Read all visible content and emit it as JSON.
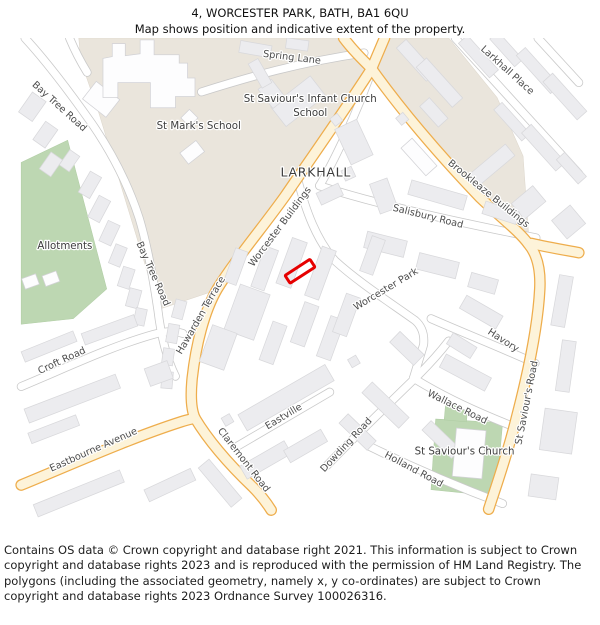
{
  "header": {
    "title": "4, WORCESTER PARK, BATH, BA1 6QU",
    "subtitle": "Map shows position and indicative extent of the property."
  },
  "map": {
    "plot_color": "#e60000",
    "area_colors": {
      "school_grounds": "#eae5dc",
      "greenspace": "#bdd7b2",
      "a_road_fill": "#fdf3d9",
      "a_road_casing": "#eead4c"
    },
    "labels": [
      {
        "id": "spring-lane",
        "text": "Spring Lane"
      },
      {
        "id": "larkhall-place",
        "text": "Larkhall Place"
      },
      {
        "id": "bay-tree-road-north",
        "text": "Bay Tree Road"
      },
      {
        "id": "st-marks-school",
        "text": "St Mark's School"
      },
      {
        "id": "st-saviours-infant-line1",
        "text": "St Saviour's Infant Church"
      },
      {
        "id": "st-saviours-infant-line2",
        "text": "School"
      },
      {
        "id": "larkhall",
        "text": "LARKHALL"
      },
      {
        "id": "brookleaze-buildings",
        "text": "Brookleaze Buildings"
      },
      {
        "id": "salisbury-road",
        "text": "Salisbury Road"
      },
      {
        "id": "worcester-buildings",
        "text": "Worcester Buildings"
      },
      {
        "id": "allotments",
        "text": "Allotments"
      },
      {
        "id": "bay-tree-road-mid",
        "text": "Bay Tree Road"
      },
      {
        "id": "worcester-park",
        "text": "Worcester Park"
      },
      {
        "id": "hawarden-terrace",
        "text": "Hawarden Terrace"
      },
      {
        "id": "havory",
        "text": "Havory"
      },
      {
        "id": "croft-road",
        "text": "Croft Road"
      },
      {
        "id": "st-saviours-road",
        "text": "St Saviour's Road"
      },
      {
        "id": "wallace-road",
        "text": "Wallace Road"
      },
      {
        "id": "eastville",
        "text": "Eastville"
      },
      {
        "id": "dowding-road",
        "text": "Dowding Road"
      },
      {
        "id": "eastbourne-avenue",
        "text": "Eastbourne Avenue"
      },
      {
        "id": "st-saviours-church",
        "text": "St Saviour's Church"
      },
      {
        "id": "claremont-road",
        "text": "Claremont Road"
      },
      {
        "id": "holland-road",
        "text": "Holland Road"
      }
    ]
  },
  "footer": {
    "attribution": "Contains OS data © Crown copyright and database right 2021. This information is subject to Crown copyright and database rights 2023 and is reproduced with the permission of HM Land Registry. The polygons (including the associated geometry, namely x, y co-ordinates) are subject to Crown copyright and database rights 2023 Ordnance Survey 100026316."
  }
}
